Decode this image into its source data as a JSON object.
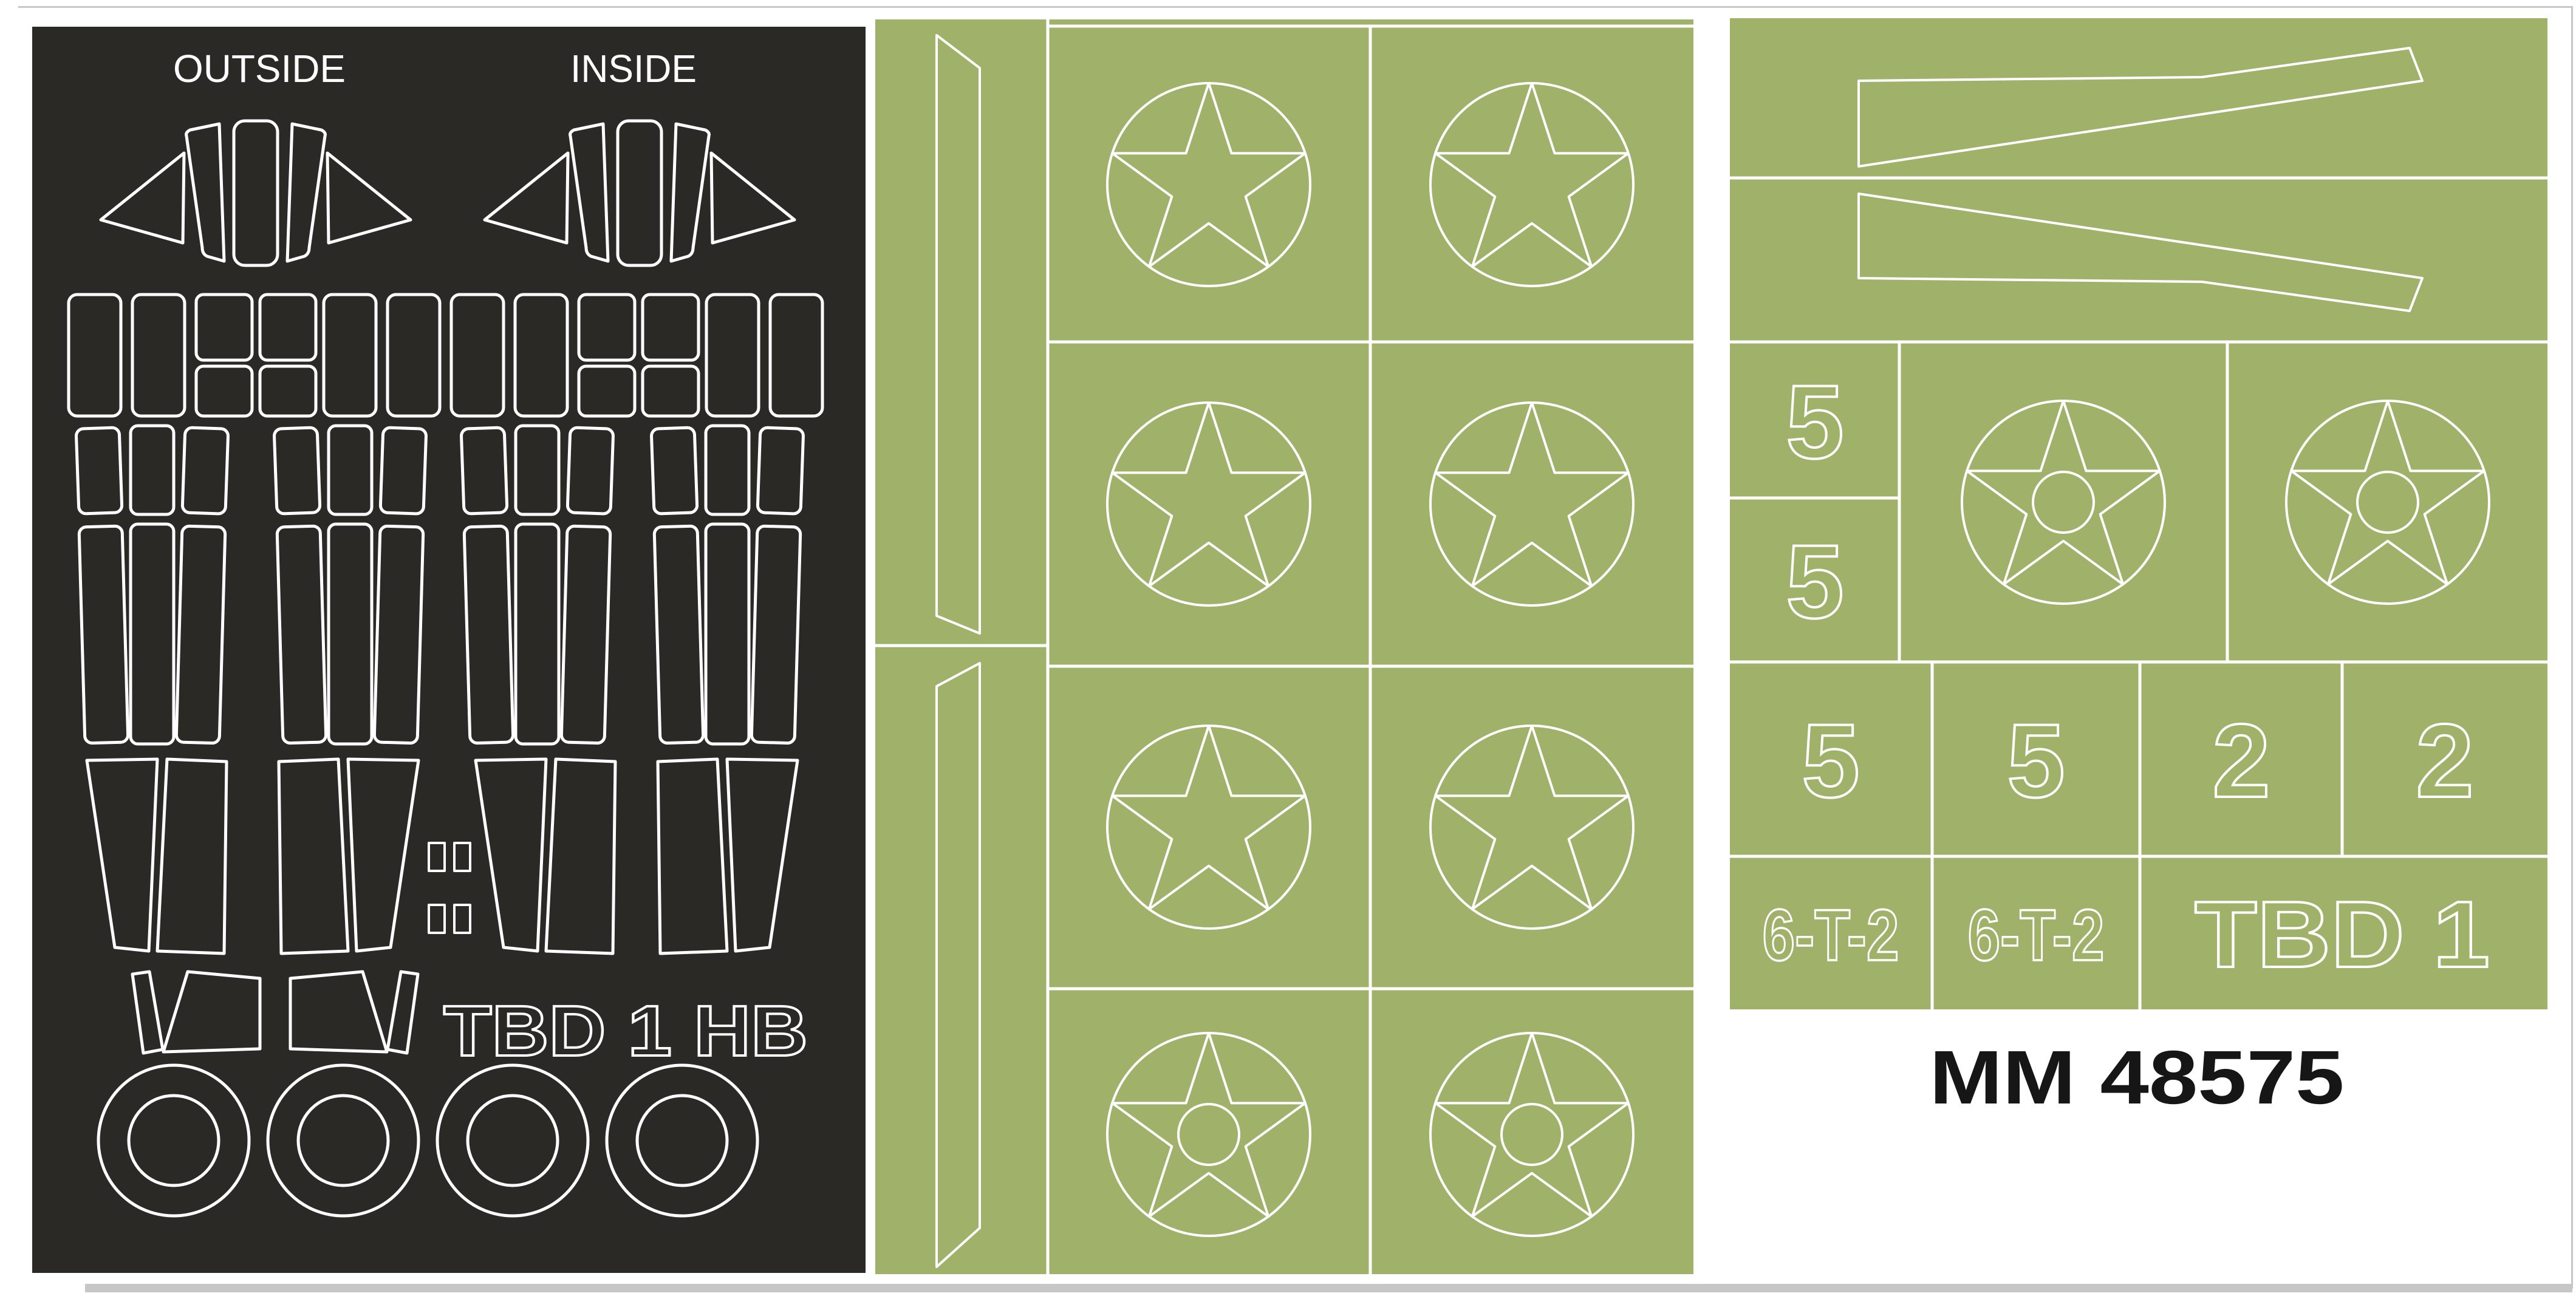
{
  "colors": {
    "black_sheet": "#2b2926",
    "green_sheet": "#a0b26a",
    "outline_white": "#ffffff",
    "code_text": "#161616"
  },
  "left_sheet": {
    "label_outside": "OUTSIDE",
    "label_inside": "INSIDE",
    "stencil_code": "TBD 1 HB"
  },
  "right_sheet": {
    "side_numerals": [
      "5",
      "5"
    ],
    "row_numerals": [
      "5",
      "5",
      "2",
      "2"
    ],
    "code_cells": [
      "6-T-2",
      "6-T-2",
      "TBD 1"
    ]
  },
  "footer": {
    "product_code": "MM 48575"
  }
}
